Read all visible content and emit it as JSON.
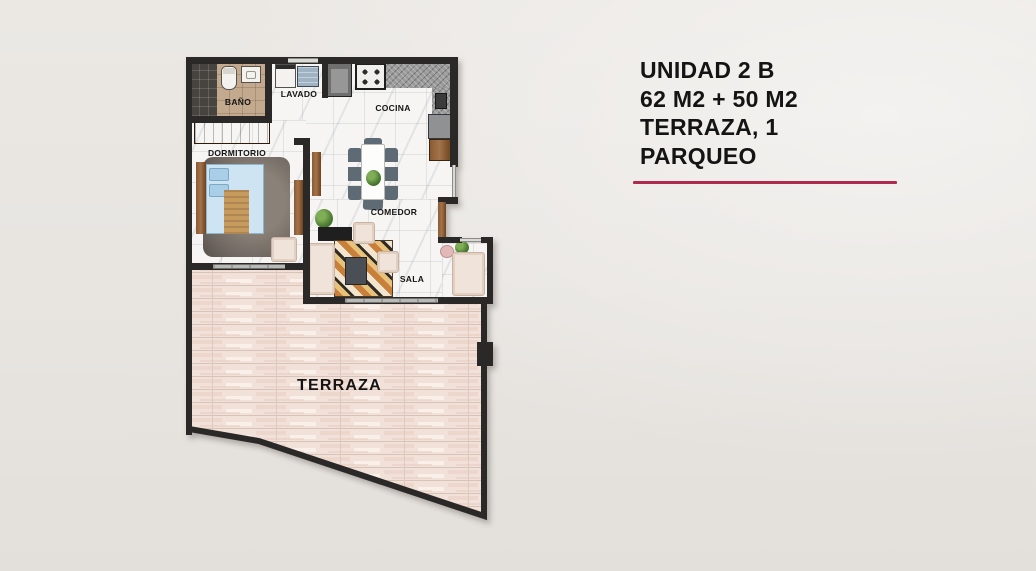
{
  "page": {
    "background": "#e9e6e2"
  },
  "floor_plan": {
    "rooms": [
      {
        "id": "bano",
        "label": "BAÑO"
      },
      {
        "id": "lavado",
        "label": "LAVADO"
      },
      {
        "id": "cocina",
        "label": "COCINA"
      },
      {
        "id": "dormitorio",
        "label": "DORMITORIO"
      },
      {
        "id": "comedor",
        "label": "COMEDOR"
      },
      {
        "id": "sala",
        "label": "SALA"
      },
      {
        "id": "terraza",
        "label": "TERRAZA"
      }
    ]
  },
  "unit_info": {
    "lines": [
      "UNIDAD 2 B",
      "62 M2 + 50 M2",
      "TERRAZA, 1",
      "PARQUEO"
    ],
    "accent_color": "#ae2b4d",
    "wall_color": "#2a2927"
  }
}
